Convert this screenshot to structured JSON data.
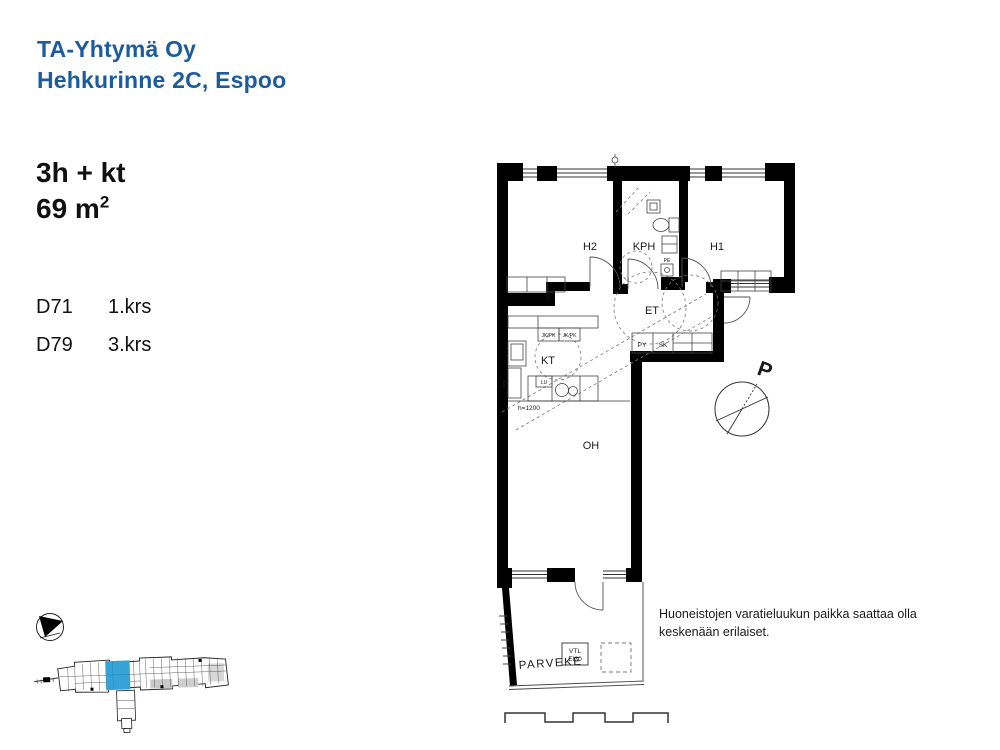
{
  "header": {
    "company": "TA-Yhtymä Oy",
    "address": "Hehkurinne 2C, Espoo"
  },
  "apartment": {
    "type": "3h + kt",
    "area_base": "69 m",
    "area_exp": "2"
  },
  "units": [
    {
      "id": "D71",
      "floor": "1.krs"
    },
    {
      "id": "D79",
      "floor": "3.krs"
    }
  ],
  "plan": {
    "rooms": {
      "h2": "H2",
      "kph": "KPH",
      "h1": "H1",
      "et": "ET",
      "kt": "KT",
      "oh": "OH",
      "parveke": "PARVEKE"
    },
    "labels": {
      "jkpk": "JK/PK",
      "py": "PY",
      "sk": "SK",
      "lu": "LU",
      "pe": "PE",
      "height_note": "h=1200",
      "dim": "2435",
      "kitchen_note": "3xM",
      "vtl_line1": "VTL",
      "vtl_line2": "EI30"
    },
    "compass_letter": "P"
  },
  "notes": {
    "disclaimer_line1": "Huoneistojen varatieluukun paikka saattaa olla",
    "disclaimer_line2": "keskenään erilaiset."
  },
  "colors": {
    "brand_blue": "#1d5c9c",
    "unit_highlight": "#35a3d8",
    "wall_black": "#000000"
  }
}
